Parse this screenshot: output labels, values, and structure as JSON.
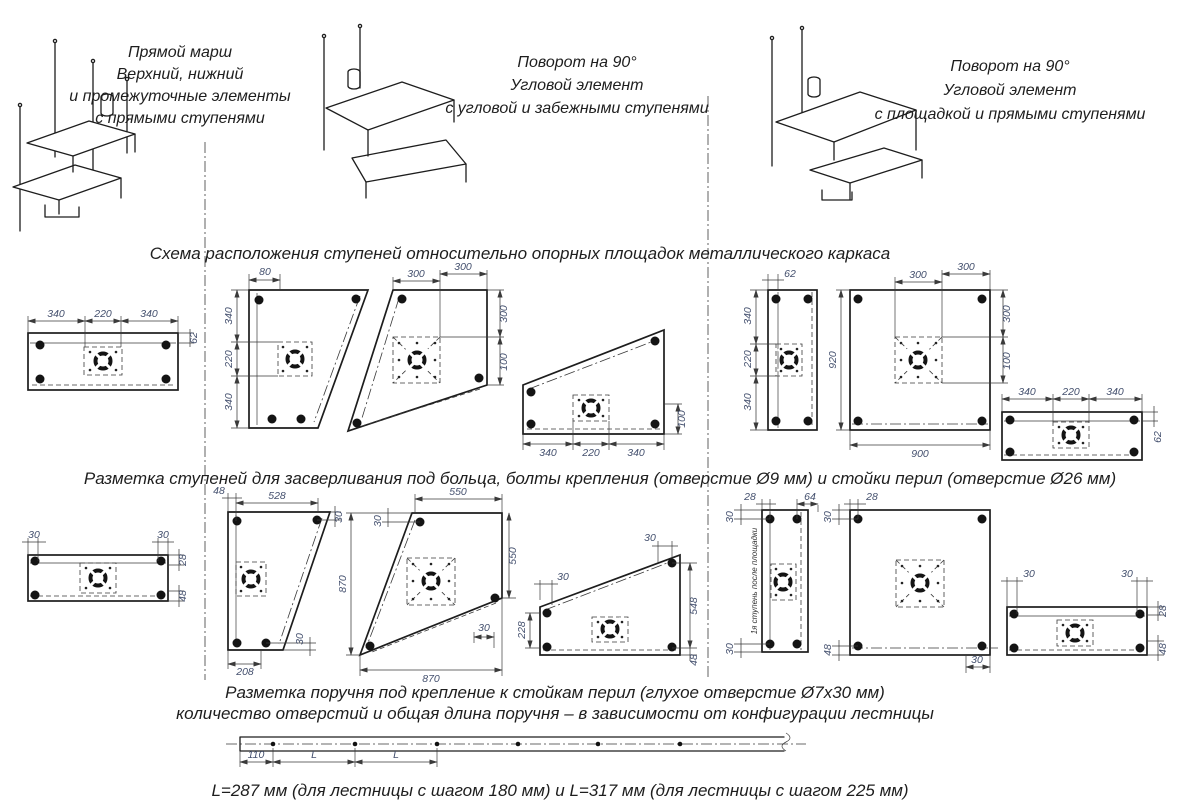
{
  "palette": {
    "background": "#ffffff",
    "line": "#1d1d1d",
    "dim_text": "#44506e"
  },
  "top_sections": [
    {
      "label_lines": [
        "Прямой марш",
        "Верхний, нижний",
        "и промежуточные элементы",
        "с прямыми ступенями"
      ]
    },
    {
      "label_lines": [
        "Поворот на 90°",
        "Угловой элемент",
        "с угловой и забежными ступенями"
      ]
    },
    {
      "label_lines": [
        "Поворот на 90°",
        "Угловой элемент",
        "с площадкой и прямыми ступенями"
      ]
    }
  ],
  "headings": {
    "layout": "Схема расположения ступеней относительно опорных площадок металлического каркаса",
    "drilling": "Разметка ступеней для засверливания под больца, болты крепления (отверстие Ø9 мм) и стойки перил (отверстие Ø26 мм)",
    "handrail_line1": "Разметка поручня под крепление к стойкам перил (глухое отверстие Ø7х30 мм)",
    "handrail_line2": "количество отверстий и общая длина поручня – в зависимости от конфигурации лестницы",
    "length_note": "L=287 мм (для лестницы с шагом 180 мм) и L=317 мм (для лестницы с шагом 225 мм)"
  },
  "row1": {
    "straight": [
      "340",
      "220",
      "340",
      "62"
    ],
    "wedge": [
      "80",
      "340",
      "220",
      "340"
    ],
    "corner": [
      "300",
      "300",
      "300",
      "100"
    ],
    "slant": [
      "340",
      "220",
      "340",
      "100"
    ],
    "strip": [
      "62",
      "340",
      "220",
      "340"
    ],
    "square": [
      "300",
      "300",
      "920",
      "900",
      "300",
      "100"
    ],
    "straight2": [
      "340",
      "220",
      "340",
      "62"
    ]
  },
  "row2": {
    "straight": [
      "30",
      "30",
      "28",
      "48"
    ],
    "wedge": [
      "48",
      "528",
      "30",
      "208",
      "30"
    ],
    "corner": [
      "30",
      "550",
      "870",
      "550",
      "30",
      "870"
    ],
    "slant": [
      "30",
      "30",
      "228",
      "548",
      "48"
    ],
    "strip": [
      "28",
      "64",
      "30",
      "30"
    ],
    "strip_note": "1я ступень после площадки",
    "square": [
      "28",
      "30",
      "48",
      "30"
    ],
    "straight2": [
      "30",
      "30",
      "28",
      "48"
    ]
  },
  "handrail": {
    "dims": [
      "110",
      "L",
      "L"
    ]
  }
}
